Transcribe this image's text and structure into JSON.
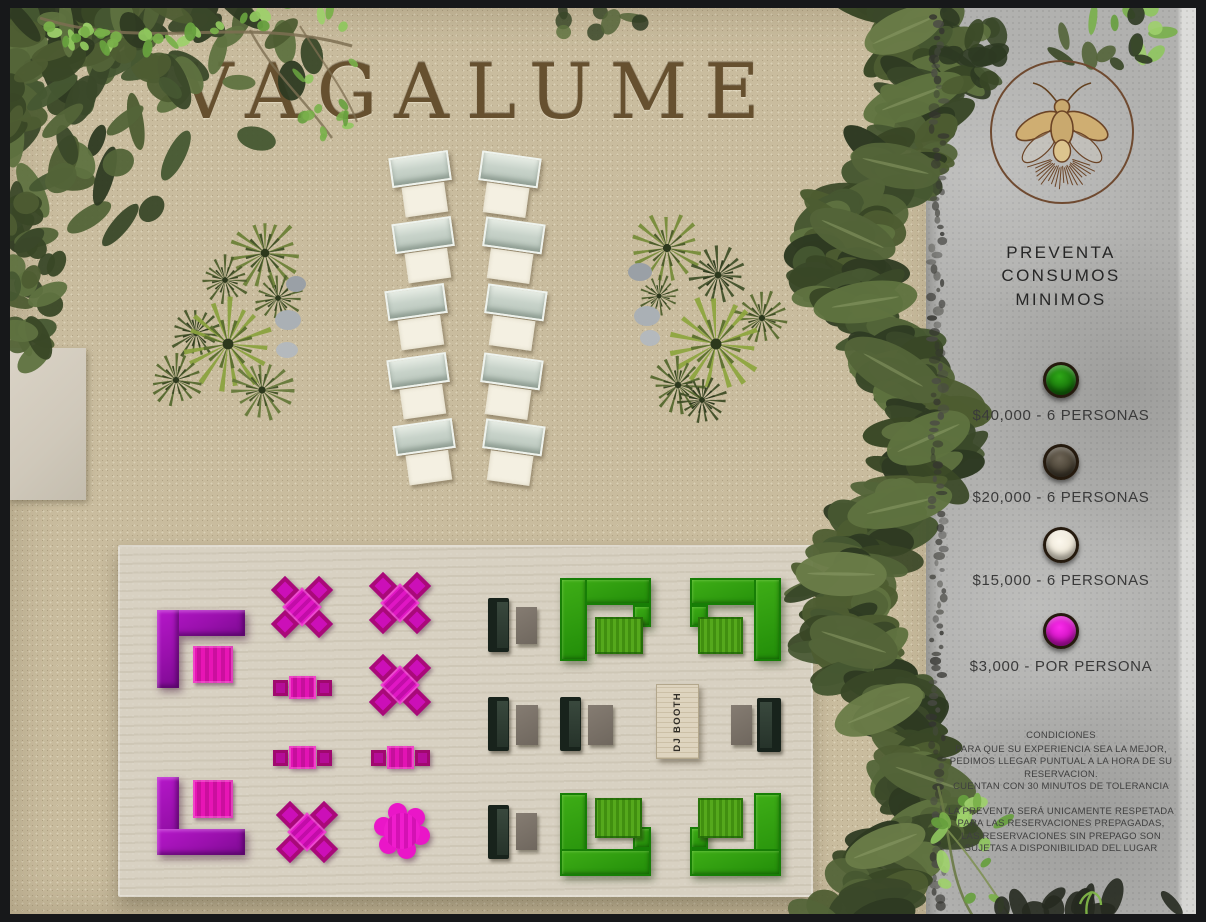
{
  "title": "VAGALUME",
  "map": {
    "dj_booth_label": "DJ BOOTH"
  },
  "sidebar": {
    "logo": "firefly-logo",
    "heading_lines": [
      "PREVENTA",
      "CONSUMOS",
      "MINIMOS"
    ],
    "tiers": [
      {
        "color": "#1e9313",
        "label": "$40,000 - 6 PERSONAS"
      },
      {
        "color": "#57503f",
        "label": "$20,000 - 6 PERSONAS"
      },
      {
        "color": "#f8f4ea",
        "label": "$15,000 - 6 PERSONAS"
      },
      {
        "color": "#ef13df",
        "label": "$3,000 - POR PERSONA"
      }
    ],
    "conditions": {
      "title": "CONDICIONES",
      "paragraph1": [
        "PARA QUE SU EXPERIENCIA SEA LA MEJOR,",
        "PEDIMOS LLEGAR PUNTUAL A LA HORA DE SU",
        "RESERVACION.",
        "CUENTAN CON 30 MINUTOS DE TOLERANCIA"
      ],
      "paragraph2": [
        "LA PREVENTA SERÁ UNICAMENTE RESPETADA",
        "PARA LAS RESERVACIONES PREPAGADAS,",
        "LAS RESERVACIONES SIN PREPAGO SON",
        "SUJETAS A DISPONIBILIDAD DEL LUGAR"
      ]
    }
  },
  "colors": {
    "sand": "#c9bc9e",
    "deck": "#d8d1c2",
    "stone_sidebar": "#b1b1af",
    "title_brown": "#66502f",
    "accent_magenta": "#d812bc",
    "accent_purple": "#9a10ad",
    "accent_green": "#2b9a0f",
    "dark_sofa": "#18231c",
    "lounger_pale": "#ccd6cc",
    "frame_dark": "#17181a"
  }
}
